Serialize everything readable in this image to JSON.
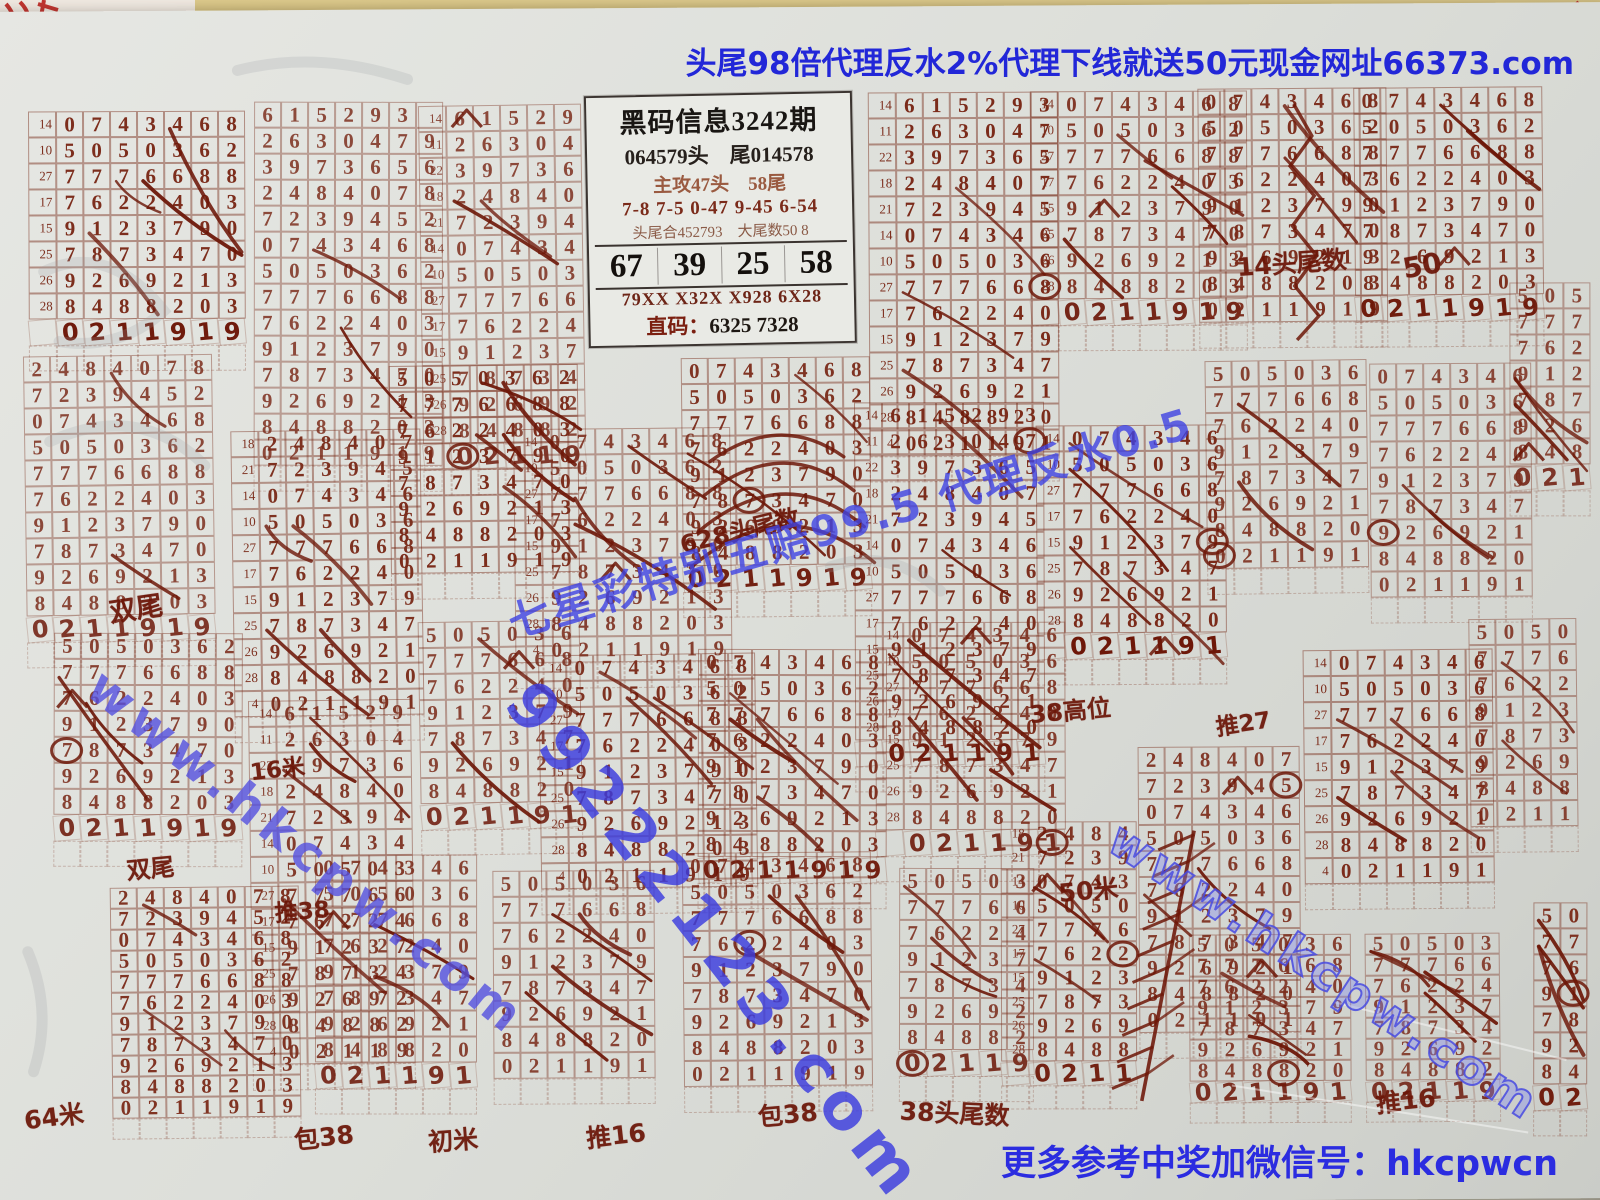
{
  "colors": {
    "paper": "#dfe0dc",
    "print_ink": "#7b2b1a",
    "handwriting": "#6d1708",
    "digital_blue": "#2227d8",
    "watermark_blue": "#3e42e2",
    "table_wood": "#d2bd7e"
  },
  "banner": {
    "text": "头尾98倍代理反水2%代理下线就送50元现金网址66373.com"
  },
  "footer": {
    "text": "更多参考中奖加微信号：hkcpwcn"
  },
  "info_box": {
    "title": "黑码信息3242期",
    "line_head_tail": "064579头　尾014578",
    "line_attack": "主攻47头　58尾",
    "line_pairs": "7-8  7-5  0-47  9-45  6-54",
    "line_sum": "头尾合452793　大尾数50 8",
    "nums": [
      "67",
      "39",
      "25",
      "58"
    ],
    "line_codes": "79XX  X32X  X928  6X28",
    "line_direct_label": "直码：",
    "line_direct_value": "6325 7328"
  },
  "watermarks": {
    "left": "www.hkcpw.com",
    "center": "99222123.com",
    "diagonal": "七星彩特别五赔99.5 代理反水0.5",
    "right": "www.hkcpw.com"
  },
  "grid": {
    "rows": [
      {
        "label": "14",
        "digits": "615293"
      },
      {
        "label": "11",
        "digits": "2630479"
      },
      {
        "label": "22",
        "digits": "3973656"
      },
      {
        "label": "18",
        "digits": "2484078"
      },
      {
        "label": "21",
        "digits": "7239452"
      },
      {
        "label": "14",
        "digits": "0743468"
      },
      {
        "label": "10",
        "digits": "5050362"
      },
      {
        "label": "27",
        "digits": "7776688"
      },
      {
        "label": "17",
        "digits": "7622403"
      },
      {
        "label": "15",
        "digits": "9123790"
      },
      {
        "label": "25",
        "digits": "7873470"
      },
      {
        "label": "26",
        "digits": "9269213"
      },
      {
        "label": "28",
        "digits": "8488203"
      },
      {
        "label": "4",
        "digits": "0211919"
      }
    ],
    "sets": {
      "A": [
        5,
        6,
        7,
        8,
        9,
        10,
        11,
        12,
        13
      ],
      "BA": [
        0,
        1,
        2,
        3,
        4,
        5,
        6,
        7,
        8,
        9,
        10,
        11,
        12,
        13
      ],
      "C": [
        3,
        4,
        5,
        6,
        7,
        8,
        9,
        10,
        11,
        12,
        13
      ],
      "S": [
        6,
        7,
        8,
        9,
        10,
        11,
        12,
        13
      ]
    }
  },
  "annotations": [
    {
      "text": "双尾",
      "x": 118,
      "y": 576,
      "size": 27,
      "rot": -8
    },
    {
      "text": "14头尾数",
      "x": 1248,
      "y": 240,
      "size": 25,
      "rot": -4
    },
    {
      "text": "50",
      "x": 1414,
      "y": 246,
      "size": 28,
      "rot": -10
    },
    {
      "text": "628头尾数",
      "x": 688,
      "y": 504,
      "size": 24,
      "rot": -13
    },
    {
      "text": "38高位",
      "x": 1038,
      "y": 686,
      "size": 24,
      "rot": -5
    },
    {
      "text": "推27",
      "x": 1224,
      "y": 700,
      "size": 23,
      "rot": -8
    },
    {
      "text": "50米",
      "x": 1066,
      "y": 866,
      "size": 25,
      "rot": -5
    },
    {
      "text": "16米",
      "x": 258,
      "y": 740,
      "size": 23,
      "rot": -6
    },
    {
      "text": "双尾",
      "x": 134,
      "y": 838,
      "size": 24,
      "rot": -5
    },
    {
      "text": "推38",
      "x": 282,
      "y": 882,
      "size": 23,
      "rot": -4
    },
    {
      "text": "64米",
      "x": 30,
      "y": 1086,
      "size": 25,
      "rot": -7
    },
    {
      "text": "包38",
      "x": 300,
      "y": 1108,
      "size": 25,
      "rot": -6
    },
    {
      "text": "初米",
      "x": 434,
      "y": 1112,
      "size": 25,
      "rot": -4
    },
    {
      "text": "推16",
      "x": 592,
      "y": 1108,
      "size": 25,
      "rot": -6
    },
    {
      "text": "包38",
      "x": 764,
      "y": 1088,
      "size": 25,
      "rot": -5
    },
    {
      "text": "38头尾数",
      "x": 906,
      "y": 1088,
      "size": 25,
      "rot": 3
    },
    {
      "text": "推16",
      "x": 1382,
      "y": 1078,
      "size": 25,
      "rot": -6
    }
  ]
}
